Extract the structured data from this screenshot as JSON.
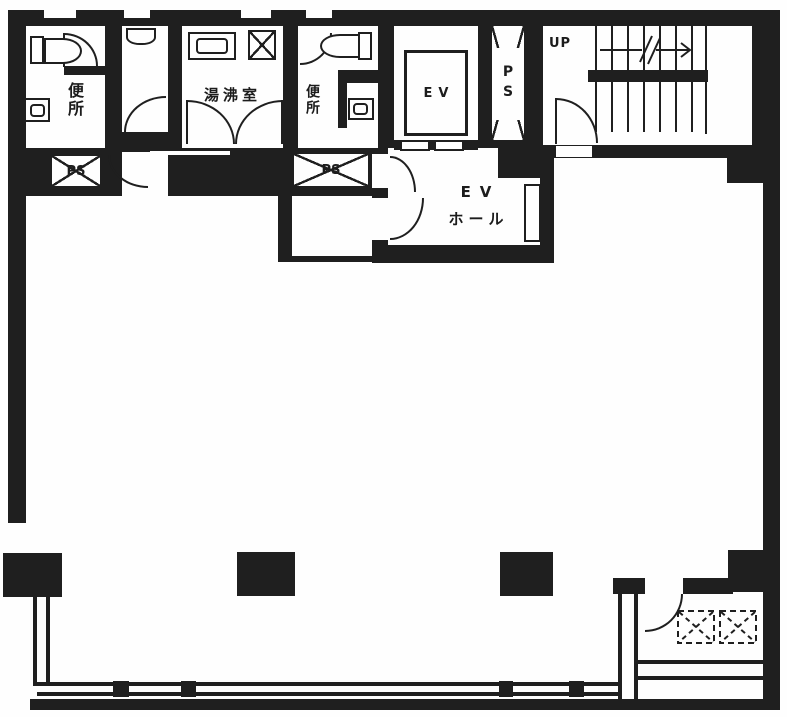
{
  "plan": {
    "labels": {
      "toilet_left": "便所",
      "kitchenette": "湯沸室",
      "toilet_right": "便所",
      "elevator": "EV",
      "shaft_vertical": "PS",
      "stairs_up": "UP",
      "shaft_left": "PS",
      "shaft_center": "PS",
      "ev_hall_line1": "EV",
      "ev_hall_line2": "ホール"
    },
    "colors": {
      "wall": "#1f1f1f",
      "background": "#fefefe"
    }
  }
}
